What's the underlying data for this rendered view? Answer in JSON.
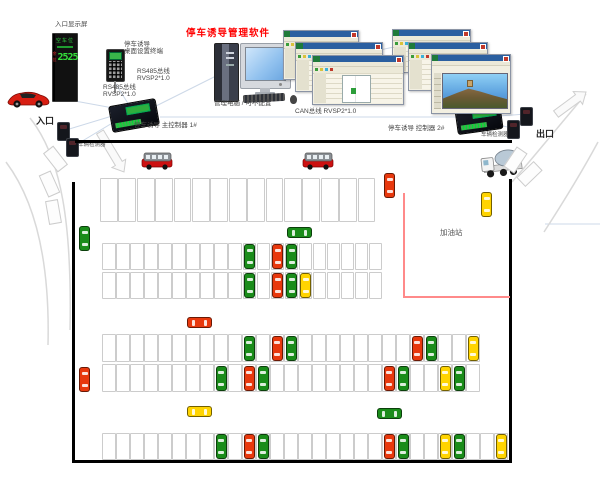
{
  "labels": {
    "display": "入口显示屏",
    "terminal1": "停车诱导",
    "terminal2": "桌面设置终端",
    "rs485a1": "RS485总线",
    "rs485a2": "RVSP2*1.0",
    "rs485b1": "RS485总线",
    "rs485b2": "RVSP2*1.0",
    "title": "停车诱导管理软件",
    "pc": "管理电脑 / 可不配置",
    "ctrl1": "停车诱导 主控制器 1#",
    "can": "CAN总线 RVSP2*1.0",
    "ctrl2": "停车诱导 控制器 2#",
    "detector_left": "车辆检测器",
    "detector_right": "车辆检测器",
    "entrance": "入口",
    "exit": "出口",
    "gas": "加油站"
  },
  "entrance_display": {
    "screen_title": "空车位",
    "vacancy_label": "余位",
    "vacancy_value": "2525"
  },
  "colors": {
    "title_red": "#ff0000",
    "car_red": "#e8380d",
    "car_green": "#1a8c1a",
    "car_yellow": "#ffd400",
    "space_border": "#cccccc",
    "gas_line": "#ff8a8a",
    "link_line": "#ccd8e8",
    "road_line": "#d9d9d9"
  },
  "parking_map": {
    "rows": [
      {
        "name": "row-1",
        "x": 100,
        "y": 178,
        "space_w": 18.4,
        "space_h": 45,
        "count": 15,
        "cars": []
      },
      {
        "name": "row-2",
        "x": 102,
        "y": 243,
        "space_w": 14.05,
        "space_h": 28,
        "count": 20,
        "cars": [
          {
            "slot": 10,
            "color": "green"
          },
          {
            "slot": 12,
            "color": "red"
          },
          {
            "slot": 13,
            "color": "green"
          }
        ]
      },
      {
        "name": "row-3",
        "x": 102,
        "y": 272,
        "space_w": 14.05,
        "space_h": 28,
        "count": 20,
        "cars": [
          {
            "slot": 10,
            "color": "green"
          },
          {
            "slot": 12,
            "color": "red"
          },
          {
            "slot": 13,
            "color": "green"
          },
          {
            "slot": 14,
            "color": "yellow"
          }
        ]
      },
      {
        "name": "row-4",
        "x": 102,
        "y": 334,
        "space_w": 14,
        "space_h": 29,
        "count": 27,
        "cars": [
          {
            "slot": 10,
            "color": "green"
          },
          {
            "slot": 12,
            "color": "red"
          },
          {
            "slot": 13,
            "color": "green"
          },
          {
            "slot": 22,
            "color": "red"
          },
          {
            "slot": 23,
            "color": "green"
          },
          {
            "slot": 26,
            "color": "yellow"
          }
        ]
      },
      {
        "name": "row-5",
        "x": 102,
        "y": 364,
        "space_w": 14,
        "space_h": 29,
        "count": 27,
        "cars": [
          {
            "slot": 8,
            "color": "green"
          },
          {
            "slot": 10,
            "color": "red"
          },
          {
            "slot": 11,
            "color": "green"
          },
          {
            "slot": 20,
            "color": "red"
          },
          {
            "slot": 21,
            "color": "green"
          },
          {
            "slot": 24,
            "color": "yellow"
          },
          {
            "slot": 25,
            "color": "green"
          }
        ]
      },
      {
        "name": "row-6",
        "x": 102,
        "y": 433,
        "space_w": 14,
        "space_h": 28,
        "count": 29,
        "cars": [
          {
            "slot": 8,
            "color": "green"
          },
          {
            "slot": 10,
            "color": "red"
          },
          {
            "slot": 11,
            "color": "green"
          },
          {
            "slot": 20,
            "color": "red"
          },
          {
            "slot": 21,
            "color": "green"
          },
          {
            "slot": 24,
            "color": "yellow"
          },
          {
            "slot": 25,
            "color": "green"
          },
          {
            "slot": 28,
            "color": "yellow"
          }
        ]
      }
    ],
    "moving_cars": [
      {
        "color": "green",
        "x": 79,
        "y": 226,
        "dir": "v"
      },
      {
        "color": "green",
        "x": 287,
        "y": 227,
        "dir": "h"
      },
      {
        "color": "red",
        "x": 187,
        "y": 317,
        "dir": "h"
      },
      {
        "color": "red",
        "x": 79,
        "y": 367,
        "dir": "v"
      },
      {
        "color": "red",
        "x": 384,
        "y": 173,
        "dir": "v"
      },
      {
        "color": "yellow",
        "x": 481,
        "y": 192,
        "dir": "v"
      },
      {
        "color": "yellow",
        "x": 187,
        "y": 406,
        "dir": "h"
      },
      {
        "color": "green",
        "x": 377,
        "y": 408,
        "dir": "h"
      }
    ],
    "buses": [
      {
        "x": 141,
        "y": 151
      },
      {
        "x": 302,
        "y": 151
      }
    ]
  }
}
